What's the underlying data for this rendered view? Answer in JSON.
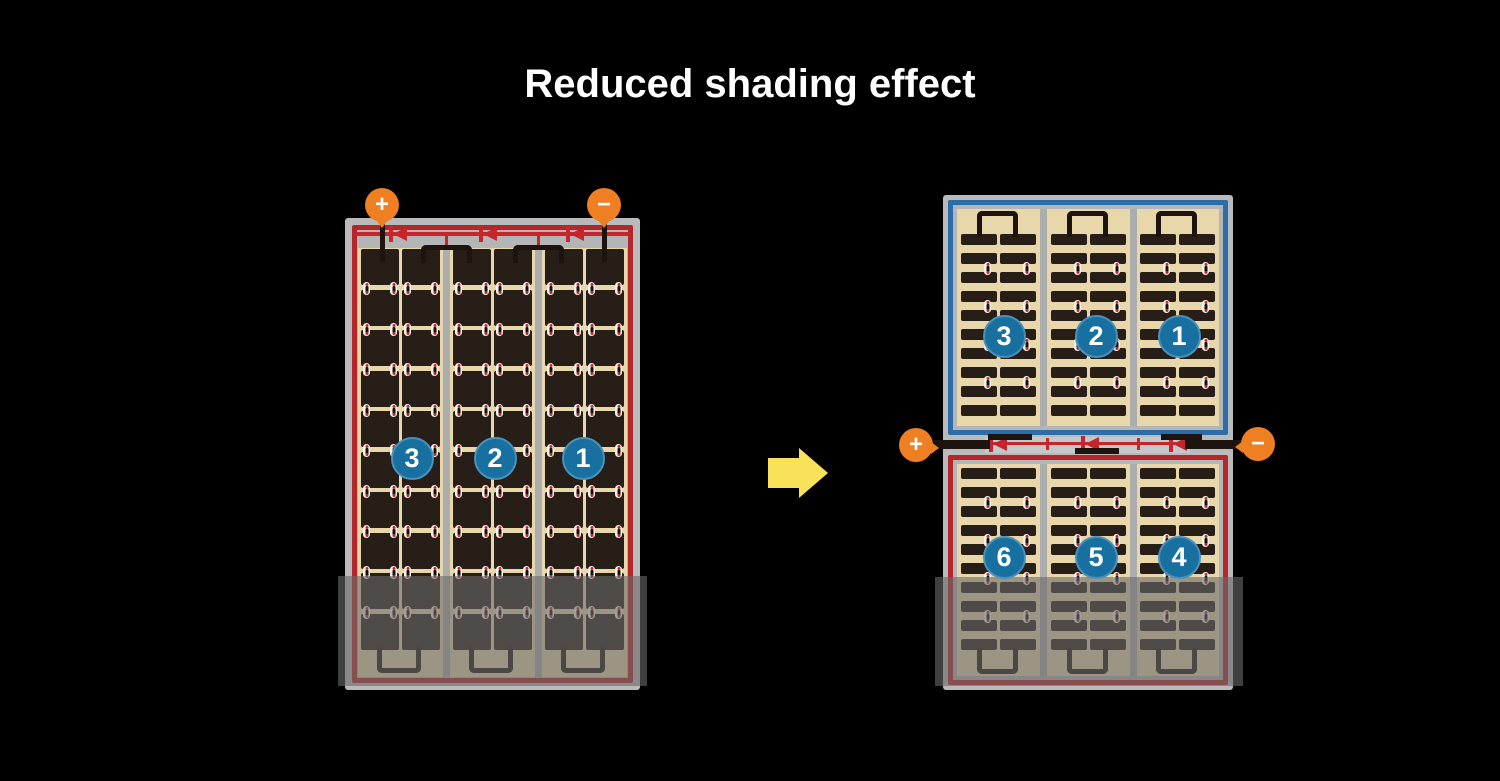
{
  "title": "Reduced shading effect",
  "colors": {
    "background": "#000000",
    "title_text": "#ffffff",
    "frame_gray": "#b9babc",
    "frame_inner_gray": "#b3b5b7",
    "junction_gray": "#c6c7c9",
    "cell_background_tan": "#e8d7aa",
    "cell_dark": "#281e18",
    "column_separator": "#acadaf",
    "red_border": "#b5262b",
    "red_wire": "#c5262c",
    "blue_border": "#2c6ca7",
    "badge_blue": "#17709f",
    "badge_rim": "#4b91ba",
    "terminal_orange": "#ee7f22",
    "wire_black": "#1d140f",
    "connector_white": "#f7f3ea",
    "arrow_yellow": "#f9e159",
    "shade_overlay": "rgba(105,105,105,0.6)"
  },
  "arrow": {
    "direction": "right"
  },
  "left_module": {
    "terminals": {
      "positive": "+",
      "negative": "−"
    },
    "string_badges": [
      "3",
      "2",
      "1"
    ],
    "cell_columns": 6,
    "cell_rows": 10,
    "bypass_diodes": 3
  },
  "right_module": {
    "terminals": {
      "positive": "+",
      "negative": "−"
    },
    "top_string_badges": [
      "3",
      "2",
      "1"
    ],
    "bottom_string_badges": [
      "6",
      "5",
      "4"
    ],
    "cell_columns": 6,
    "cell_rows_per_half": 10,
    "bypass_diodes": 3
  }
}
